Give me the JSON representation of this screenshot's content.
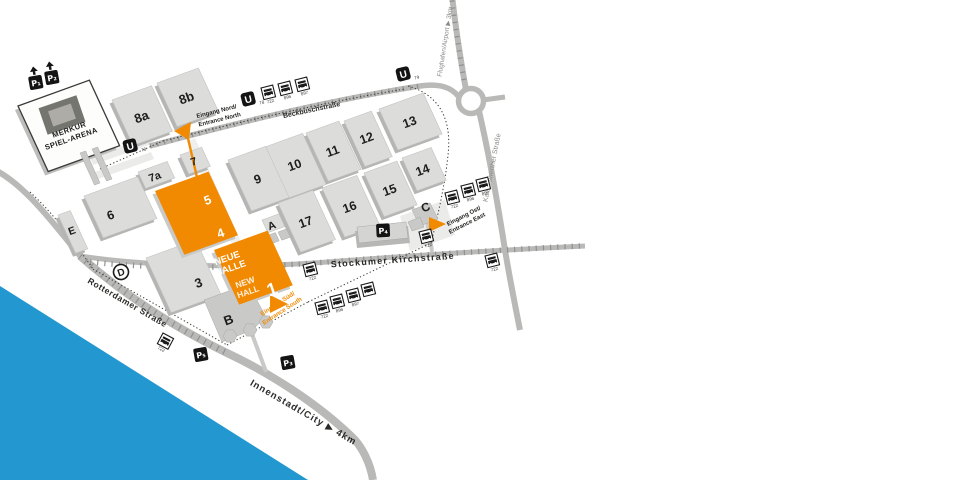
{
  "map": {
    "arena": {
      "line1": "MERKUR",
      "line2": "SPIEL-ARENA"
    },
    "halls": {
      "h8a": "8a",
      "h8b": "8b",
      "h9": "9",
      "h10": "10",
      "h11": "11",
      "h12": "12",
      "h13": "13",
      "h14": "14",
      "h15": "15",
      "h16": "16",
      "h17": "17",
      "h7": "7",
      "h7a": "7a",
      "h6": "6",
      "h5": "5",
      "h4": "4",
      "h3": "3",
      "hE": "E",
      "hA": "A",
      "hB": "B",
      "hC": "C",
      "hD": "D"
    },
    "new_hall": {
      "de_line1": "NEUE",
      "de_line2": "HALLE",
      "en_line1": "NEW",
      "en_line2": "HALL",
      "number": "1"
    },
    "entrances": {
      "north_de": "Eingang Nord/",
      "north_en": "Entrance North",
      "east_de": "Eingang Ost/",
      "east_en": "Entrance East",
      "south_de": "Eingang Süd/",
      "south_en": "Entrance South"
    },
    "streets": {
      "beckbusch": "Beckbuschstraße",
      "stockumer": "Stockumer Kirchstraße",
      "rotterdamer": "Rotterdamer Straße",
      "kaiserswerther": "Kaiserswerther Straße",
      "airport": "Flughafen/Airport ▶ 3km",
      "city": "Innenstadt/City ▶ 4km"
    },
    "parking": {
      "p1": "P₁",
      "p2": "P₂",
      "p3": "P₃",
      "p4": "P₄",
      "p5": "P₅"
    },
    "transit": {
      "u": "U",
      "u78": "78",
      "u79": "79",
      "r722": "722",
      "r896": "896",
      "r897": "897"
    },
    "colors": {
      "orange": "#f18a00",
      "river": "#2397cf",
      "hall": "#dcdcdb",
      "road": "#b9b9b7"
    }
  }
}
